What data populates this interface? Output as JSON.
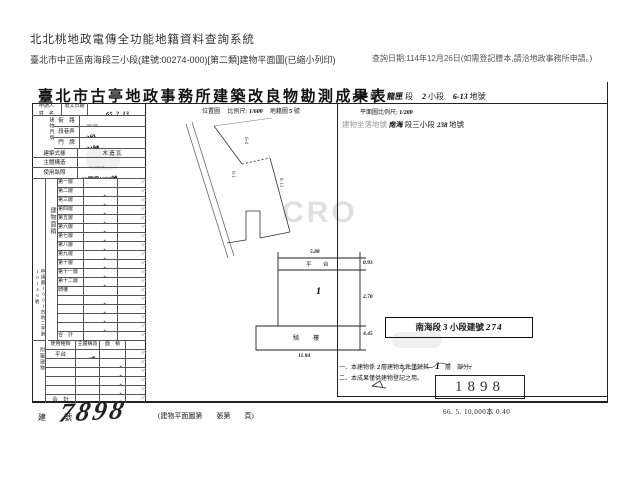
{
  "colors": {
    "ink": "#1a1a1a",
    "faint_print": "#9a9a9a"
  },
  "header": {
    "system_title": "北北桃地政電傳全功能地籍資料查詢系統",
    "document_subtitle": "臺北市中正區南海段三小段(建號:00274-000)[第二類]建物平面圖(已縮小列印)",
    "query_date_note": "查詢日期:114年12月26日(如需登記謄本,請洽地政事務所申請。)"
  },
  "form": {
    "title": "臺北市古亭地政事務所建築改良物勘測成果表",
    "land_ref": {
      "district_hand": "古亭",
      "district": "區",
      "section_hand": "龍匣",
      "section": "段",
      "subsection_hand": "2",
      "subsection": "小段",
      "lot_hand": "6-13",
      "lot": "地號"
    },
    "row1": {
      "applicant_l1": "申請人",
      "applicant_l2": "姓　名",
      "recv_label": "收文日期",
      "recv_date": "65. 2. 13"
    },
    "door": {
      "vlabel": "建物門牌",
      "rows": [
        {
          "label": "街　路",
          "value": "南海"
        },
        {
          "label": "段巷弄",
          "value": "3段"
        },
        {
          "label": "門　牌",
          "value": "23號"
        }
      ]
    },
    "info_rows": [
      {
        "label": "建築式樣",
        "value": "木 造 瓦"
      },
      {
        "label": "主體構造",
        "value": "加強磚造"
      },
      {
        "label": "使用執照",
        "value": "66使字1058號"
      }
    ],
    "area": {
      "vlabel": "建物面積",
      "side_note": "申請書(66)古地二字第10146號",
      "unit": "㎡",
      "rows": [
        {
          "label": "第一層",
          "value": "50.62"
        },
        {
          "label": "第二層",
          "value": ""
        },
        {
          "label": "第三層",
          "value": ""
        },
        {
          "label": "第四層",
          "value": ""
        },
        {
          "label": "第五層",
          "value": ""
        },
        {
          "label": "第六層",
          "value": ""
        },
        {
          "label": "第七層",
          "value": ""
        },
        {
          "label": "第八層",
          "value": ""
        },
        {
          "label": "第九層",
          "value": ""
        },
        {
          "label": "第十層",
          "value": ""
        },
        {
          "label": "第十一層",
          "value": ""
        },
        {
          "label": "第十二層",
          "value": ""
        },
        {
          "label": "騎樓",
          "value": "38.09"
        },
        {
          "label": "",
          "value": ""
        },
        {
          "label": "",
          "value": ""
        },
        {
          "label": "",
          "value": ""
        },
        {
          "label": "",
          "value": ""
        },
        {
          "label": "合　計",
          "value": "88.71"
        }
      ]
    },
    "annex": {
      "vlabel": "附屬建物",
      "header": {
        "use": "使用種類",
        "structure": "主體構造",
        "area": "面　積"
      },
      "unit": "㎡",
      "rows": [
        {
          "use": "平台",
          "structure": "加強磚造",
          "area": "7.99"
        },
        {
          "use": "",
          "structure": "",
          "area": ""
        },
        {
          "use": "",
          "structure": "",
          "area": ""
        },
        {
          "use": "",
          "structure": "",
          "area": ""
        },
        {
          "use": "",
          "structure": "",
          "area": ""
        },
        {
          "use": "合　計",
          "structure": "",
          "area": "7.99"
        }
      ]
    },
    "map": {
      "caption": {
        "t1": "位置圖",
        "t2": "比例尺:",
        "frac": "1/600",
        "t3": "地籍圖",
        "num": "5",
        "t4": "號"
      },
      "labels": [
        "6-4",
        "6-1",
        "6-13"
      ]
    },
    "plan": {
      "scale_label": "平面圖比例尺:",
      "scale_value": "1/200",
      "site": {
        "label": "建物坐落地號",
        "hand1": "南海",
        "mid": "段三小段",
        "hand2": "238",
        "tail": "地號"
      },
      "labels": {
        "terrace": "平　台",
        "floor": "1",
        "arcade": "騎　樓"
      },
      "dims": {
        "top": "5.88",
        "upper_right": "0.93",
        "mid_right": "2.70",
        "lower_right": "4.45",
        "bottom": "11.94"
      }
    },
    "stamps": {
      "section_box": {
        "p1": "南海段",
        "h1": "3",
        "p2": "小段建號",
        "h2": "274"
      },
      "number": "1898"
    },
    "notes": {
      "n1_pre": "一、本建物係",
      "n1_hand": "2",
      "n1_mid": "層建物本件僅就其",
      "n1_big": "1",
      "n1_post": "層　部分。",
      "n2": "二、本成果僅供建物登記之用。"
    },
    "footer": {
      "field_label": "建　號",
      "building_no": "7898",
      "sheet_note": "(建物平面圖第　　張第　　頁)",
      "print_code": "66. 5. 10,000本 0.40"
    },
    "watermark": "CRO"
  }
}
